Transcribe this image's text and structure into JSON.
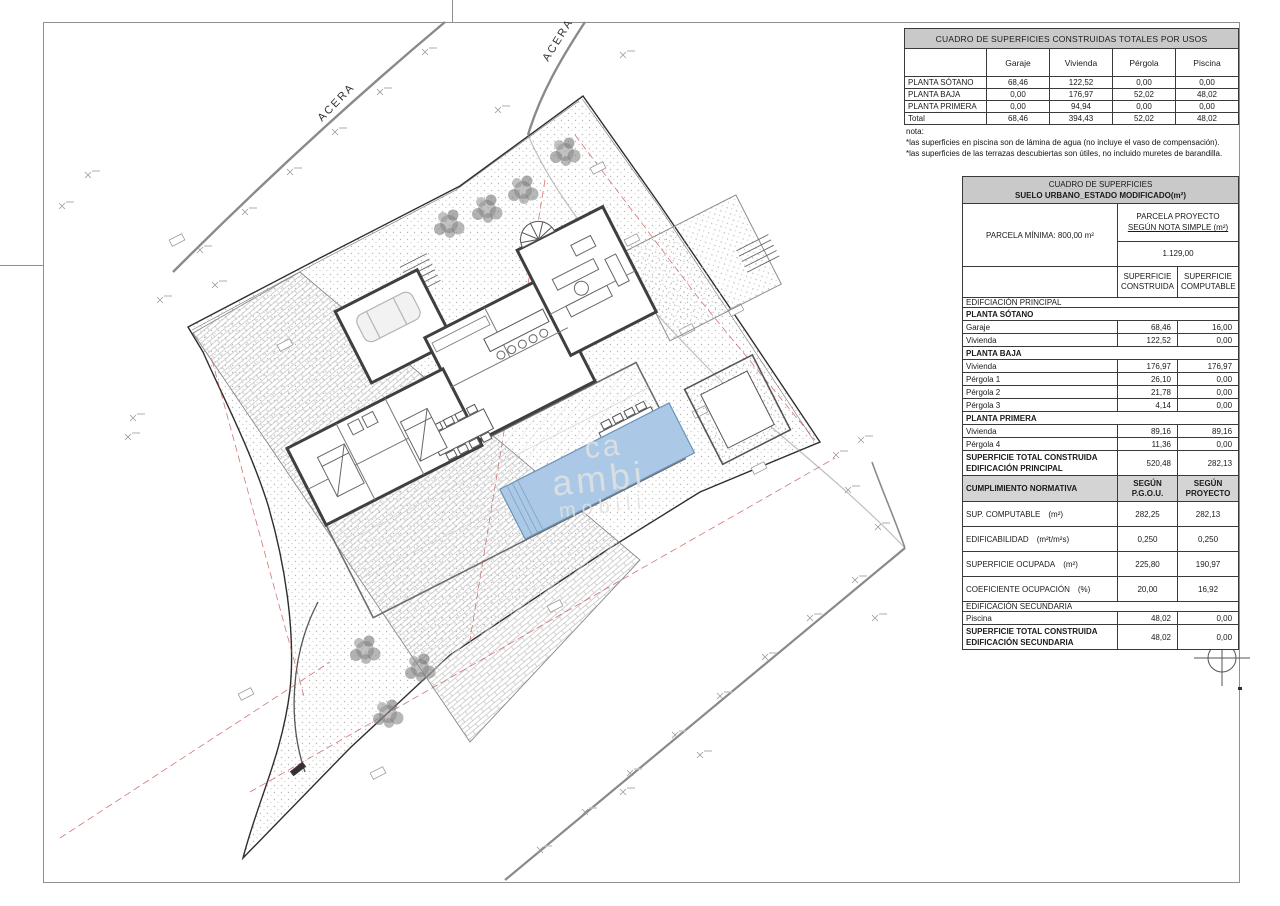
{
  "sheet": {
    "acera_left": "ACERA",
    "acera_right": "ACERA",
    "north_label": "N",
    "watermark": [
      "ca",
      "ambi",
      "mobili"
    ]
  },
  "totals_table": {
    "title": "CUADRO DE SUPERFICIES CONSTRUIDAS TOTALES POR USOS",
    "columns": [
      "",
      "Garaje",
      "Vivienda",
      "Pérgola",
      "Piscina"
    ],
    "rows": [
      [
        "PLANTA SÓTANO",
        "68,46",
        "122,52",
        "0,00",
        "0,00"
      ],
      [
        "PLANTA BAJA",
        "0,00",
        "176,97",
        "52,02",
        "48,02"
      ],
      [
        "PLANTA PRIMERA",
        "0,00",
        "94,94",
        "0,00",
        "0,00"
      ],
      [
        "Total",
        "68,46",
        "394,43",
        "52,02",
        "48,02"
      ]
    ],
    "notes": [
      "nota:",
      "*las superficies en piscina son de lámina de agua (no incluye el vaso de compensación).",
      "*las superficies de las terrazas descubiertas son útiles, no incluido muretes de barandilla."
    ]
  },
  "surface_table": {
    "title_line1": "CUADRO DE SUPERFICIES",
    "title_line2": "SUELO URBANO_ESTADO MODIFICADO(m²)",
    "parcela_minima": "PARCELA MÍNIMA: 800,00 m²",
    "parcela_proyecto_line1": "PARCELA PROYECTO",
    "parcela_proyecto_line2": "SEGÚN NOTA SIMPLE (m²)",
    "parcela_proyecto_valor": "1.129,00",
    "col1": "SUPERFICIE CONSTRUIDA",
    "col2": "SUPERFICIE COMPUTABLE",
    "rows": [
      {
        "type": "section",
        "label": "EDIFCIACIÓN PRINCIPAL"
      },
      {
        "type": "sub",
        "label": "PLANTA SÓTANO"
      },
      {
        "type": "data",
        "label": "Garaje",
        "v1": "68,46",
        "v2": "16,00"
      },
      {
        "type": "data",
        "label": "Vivienda",
        "v1": "122,52",
        "v2": "0,00"
      },
      {
        "type": "sub",
        "label": "PLANTA BAJA"
      },
      {
        "type": "data",
        "label": "Vivienda",
        "v1": "176,97",
        "v2": "176,97"
      },
      {
        "type": "data",
        "label": "Pérgola 1",
        "v1": "26,10",
        "v2": "0,00"
      },
      {
        "type": "data",
        "label": "Pérgola 2",
        "v1": "21,78",
        "v2": "0,00"
      },
      {
        "type": "data",
        "label": "Pérgola 3",
        "v1": "4,14",
        "v2": "0,00"
      },
      {
        "type": "sub",
        "label": "PLANTA PRIMERA"
      },
      {
        "type": "data",
        "label": "Vivienda",
        "v1": "89,16",
        "v2": "89,16"
      },
      {
        "type": "data",
        "label": "Pérgola 4",
        "v1": "11,36",
        "v2": "0,00"
      },
      {
        "type": "total",
        "label": "SUPERFICIE TOTAL CONSTRUIDA\nEDIFICACIÓN PRINCIPAL",
        "v1": "520,48",
        "v2": "282,13"
      },
      {
        "type": "normhdr",
        "label": "CUMPLIMIENTO NORMATIVA",
        "v1": "SEGÚN P.G.O.U.",
        "v2": "SEGÚN\nPROYECTO"
      },
      {
        "type": "norm",
        "label": "SUP. COMPUTABLE",
        "unit": "(m²)",
        "v1": "282,25",
        "v2": "282,13"
      },
      {
        "type": "norm",
        "label": "EDIFICABILIDAD",
        "unit": "(m²t/m²s)",
        "v1": "0,250",
        "v2": "0,250"
      },
      {
        "type": "norm",
        "label": "SUPERFICIE OCUPADA",
        "unit": "(m²)",
        "v1": "225,80",
        "v2": "190,97"
      },
      {
        "type": "norm",
        "label": "COEFICIENTE OCUPACIÓN",
        "unit": "(%)",
        "v1": "20,00",
        "v2": "16,92"
      },
      {
        "type": "section",
        "label": "EDIFICACIÓN SECUNDARIA"
      },
      {
        "type": "data",
        "label": "Piscina",
        "v1": "48,02",
        "v2": "0,00"
      },
      {
        "type": "total",
        "label": "SUPERFICIE TOTAL CONSTRUIDA\nEDIFICACIÓN SECUNDARIA",
        "v1": "48,02",
        "v2": "0,00"
      }
    ]
  }
}
